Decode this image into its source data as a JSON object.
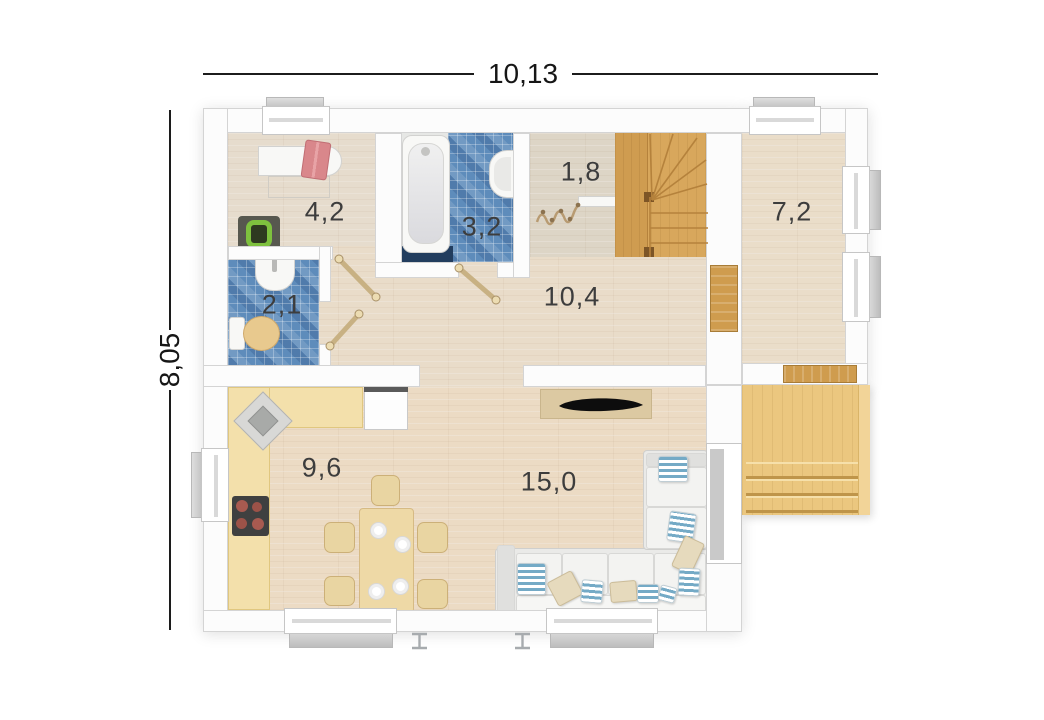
{
  "plan": {
    "type": "floor-plan-top-view",
    "overall_dimensions": {
      "width_label": "10,13",
      "height_label": "8,05"
    }
  },
  "rooms": [
    {
      "name": "room-top-left",
      "label": "4,2"
    },
    {
      "name": "bathroom",
      "label": "3,2"
    },
    {
      "name": "entry-nook",
      "label": "1,8"
    },
    {
      "name": "room-right",
      "label": "7,2"
    },
    {
      "name": "wc",
      "label": "2,1"
    },
    {
      "name": "hallway",
      "label": "10,4"
    },
    {
      "name": "kitchen",
      "label": "9,6"
    },
    {
      "name": "living-room",
      "label": "15,0"
    }
  ],
  "fixtures": [
    "bathtub",
    "wall-basin",
    "wc-basin",
    "toilet",
    "washstand-table",
    "armchair",
    "coat-rack",
    "bench",
    "winder-staircase",
    "interior-door",
    "terrace-door",
    "corner-sink",
    "cooktop",
    "fridge",
    "dining-table",
    "dining-chair",
    "plate",
    "corner-sofa",
    "cushion",
    "tv-console",
    "terrace-deck",
    "terrace-steps",
    "window",
    "section-mark"
  ],
  "colors": {
    "tile_blue": "#5e8cbb",
    "wood_floor": "#e9dcc9",
    "stair_wood": "#d8a75c",
    "terrace_wood": "#ebc77f",
    "kitchen_counter": "#f3e0ab",
    "door_wood": "#cf9c4e",
    "sofa_fabric": "#eaeae8",
    "pillow_stripe_blue": "#74aac6",
    "towel_pink": "#d9878b",
    "chair_green": "#7ec13e",
    "mat_navy": "#223d5e"
  }
}
